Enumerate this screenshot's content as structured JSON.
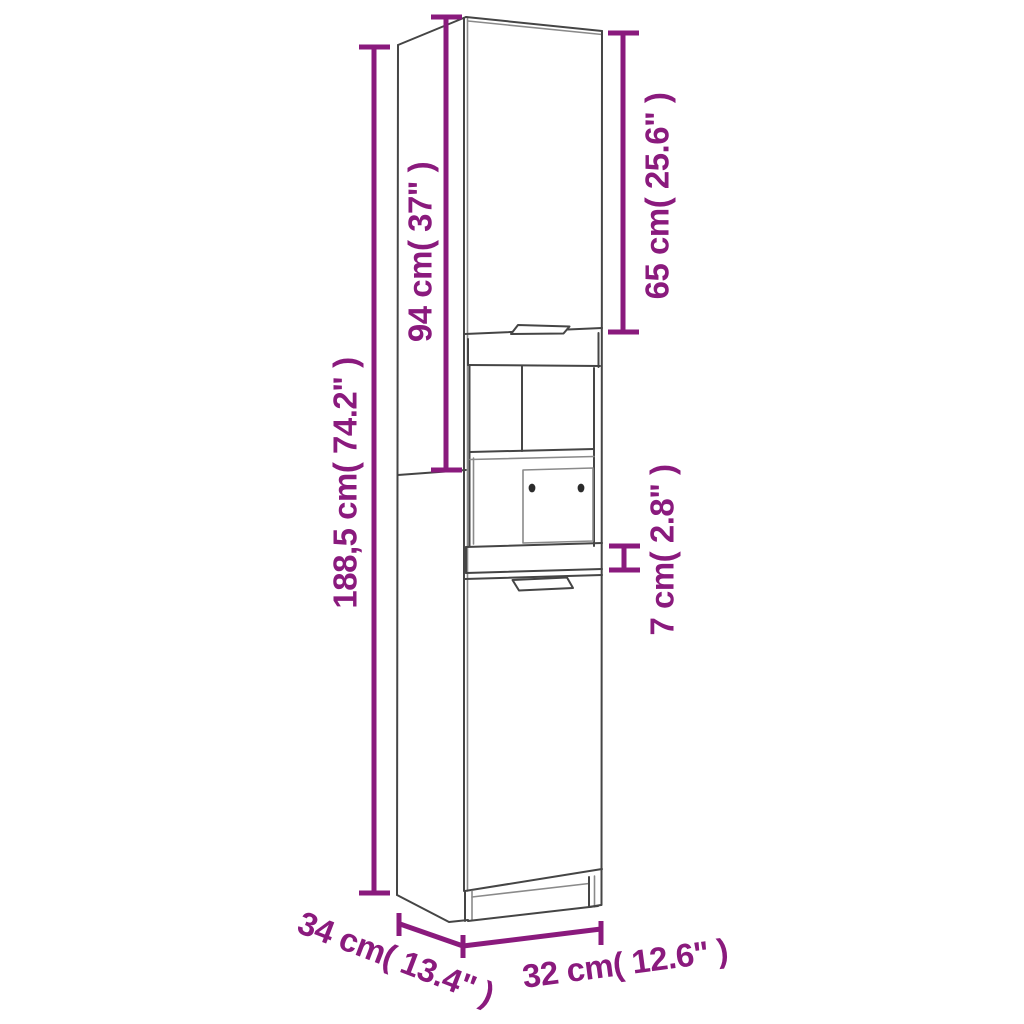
{
  "diagram": {
    "subject": "tall-cabinet-line-drawing",
    "accent_color": "#8a1a7d",
    "line_color": "#454545",
    "background_color": "#ffffff",
    "labels": {
      "total_height": "188,5 cm( 74.2\" )",
      "upper_section_height": "94 cm( 37\" )",
      "top_door_height": "65 cm( 25.6\" )",
      "rail_height": "7 cm( 2.8\" )",
      "depth": "34 cm( 13.4\" )",
      "width": "32 cm( 12.6\" )"
    },
    "values": {
      "total_height_cm": "188,5",
      "total_height_inch": "74.2",
      "upper_section_height_cm": "94",
      "upper_section_height_inch": "37",
      "top_door_height_cm": "65",
      "top_door_height_inch": "25.6",
      "rail_height_cm": "7",
      "rail_height_inch": "2.8",
      "depth_cm": "34",
      "depth_inch": "13.4",
      "width_cm": "32",
      "width_inch": "12.6"
    }
  }
}
